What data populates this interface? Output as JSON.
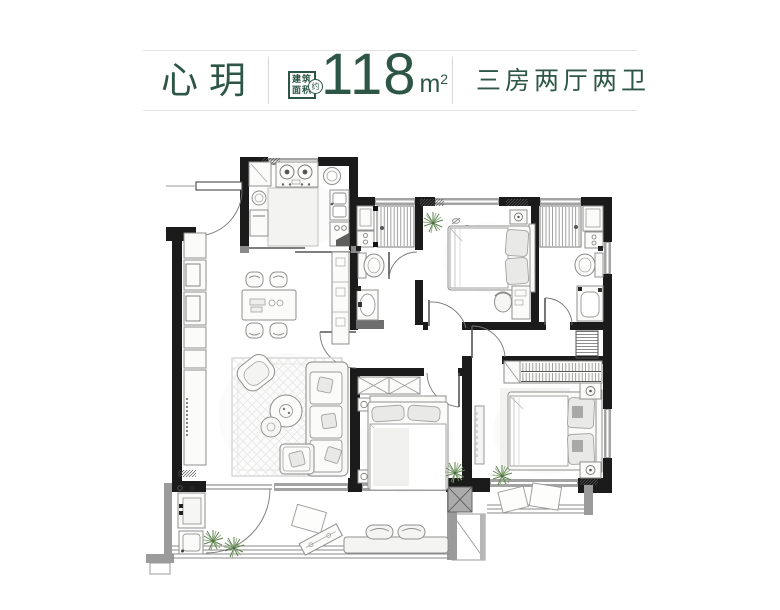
{
  "header": {
    "title": "心玥",
    "area_badge_line1": "建筑",
    "area_badge_line2": "面积",
    "area_badge_circle": "约",
    "area_value": "118",
    "area_unit_base": "m",
    "area_unit_exp": "2",
    "layout_label": "三房两厅两卫"
  },
  "colors": {
    "accent_green": "#2d5646",
    "wall_black": "#1b1b1b",
    "window_gray": "#9e9e9e",
    "balcony_gray": "#9b9b9b",
    "furniture_stroke": "#8f8f8f",
    "plant_green": "#5d8150",
    "hairline": "#e3e3e3"
  },
  "floorplan_note": {
    "type": "apartment-floor-plan",
    "rooms_visible": [
      "kitchen",
      "dining",
      "living",
      "entry",
      "bathroom-1",
      "bathroom-2",
      "bedroom-top",
      "bedroom-middle",
      "master-bedroom",
      "main-balcony",
      "secondary-balcony",
      "corridor"
    ]
  }
}
